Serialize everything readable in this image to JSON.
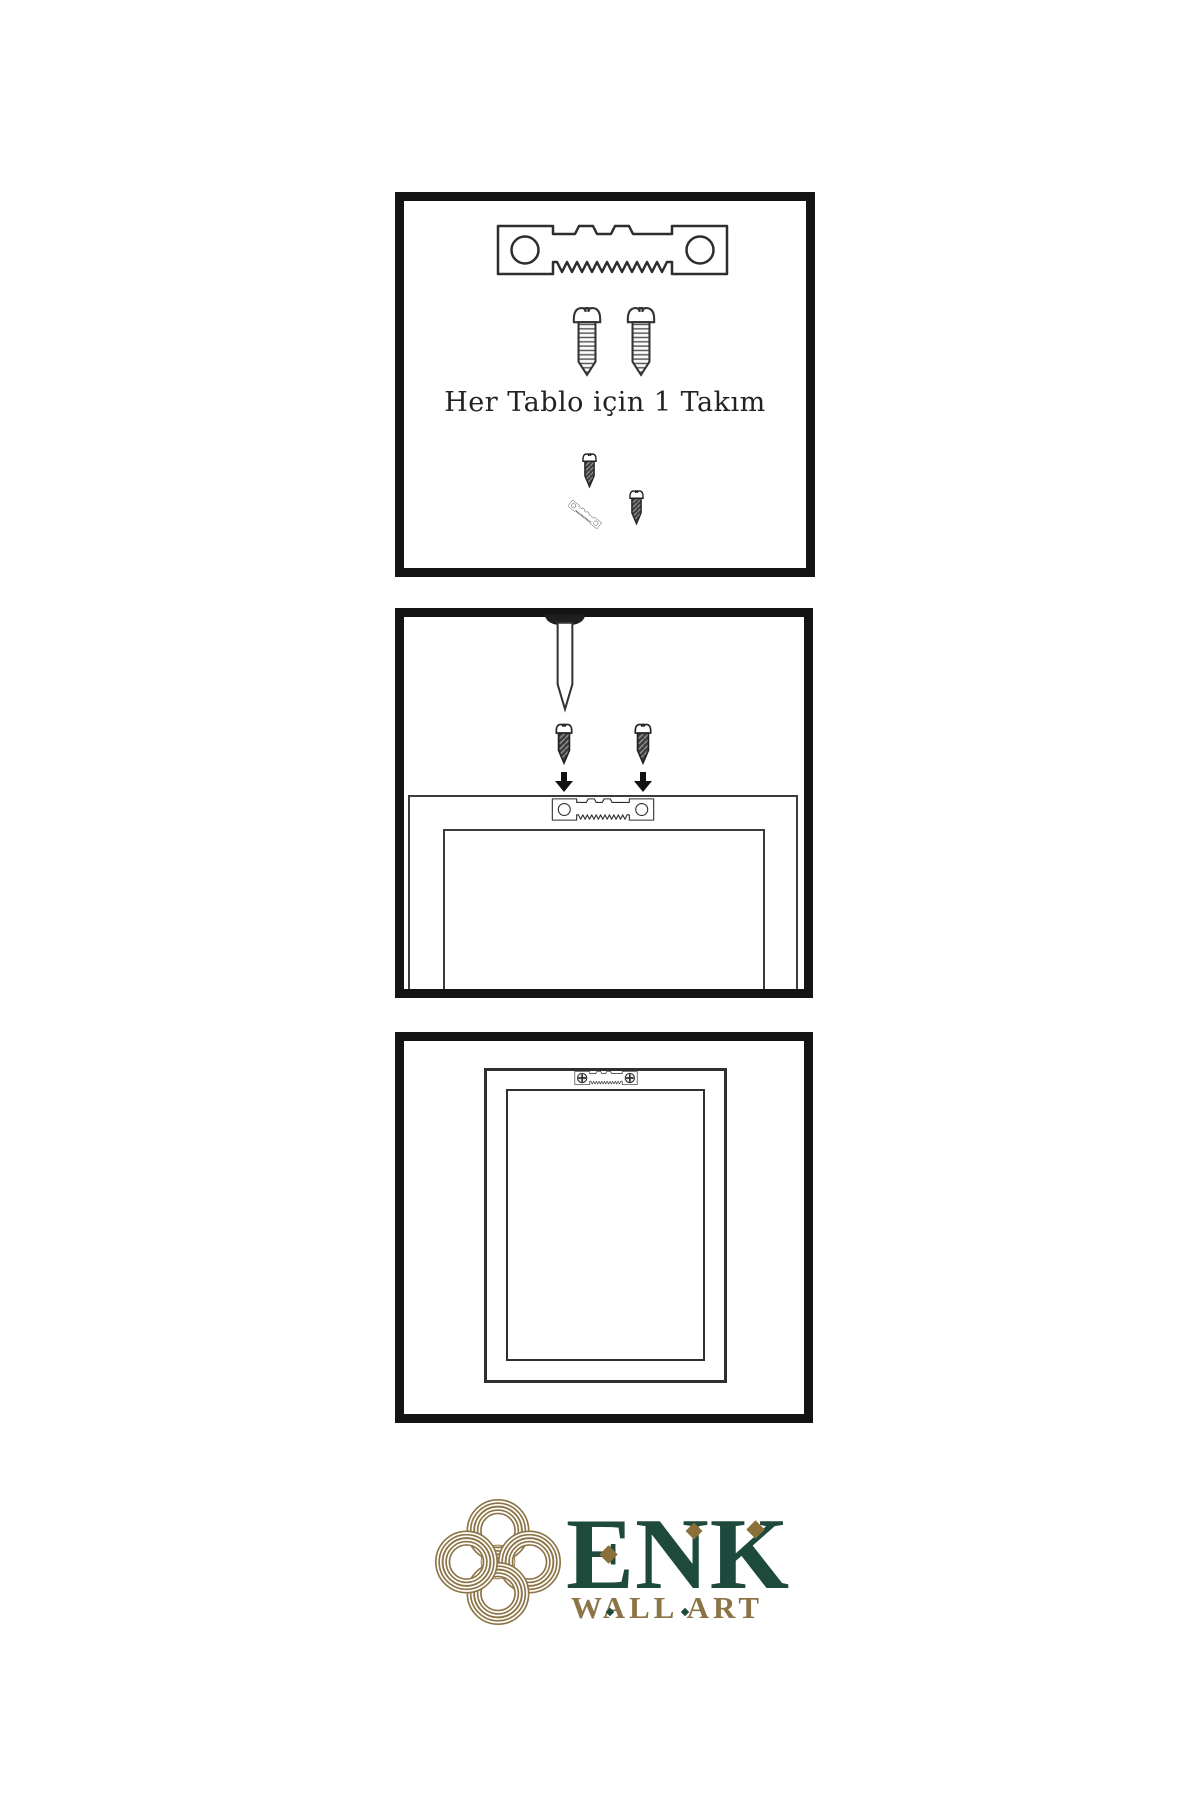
{
  "colors": {
    "background": "#ffffff",
    "panel_border": "#141414",
    "line": "#2e2e2e",
    "text": "#222222",
    "dark_metal": "#3d3d3d",
    "brand_green": "#1d4a3c",
    "brand_gold": "#8c7446",
    "brand_gold_dark": "#8a6f3a"
  },
  "panels": {
    "kit": {
      "name": "hardware-kit",
      "caption": "Her Tablo için 1 Takım",
      "icons": [
        "sawtooth-hanger-icon",
        "screw-icon",
        "screw-icon",
        "small-screw-icon",
        "angled-sawtooth-hanger-icon",
        "small-screw-icon"
      ]
    },
    "mount": {
      "name": "attach-hanger-to-frame-back",
      "icons": [
        "wall-nail-icon",
        "small-screw-icon",
        "small-screw-icon",
        "arrow-down-icon",
        "arrow-down-icon",
        "frame-back-outline",
        "sawtooth-hanger-icon"
      ]
    },
    "hang": {
      "name": "frame-hanging-on-wall",
      "icons": [
        "picture-frame-outline",
        "mounted-sawtooth-hanger-icon"
      ]
    }
  },
  "brand": {
    "name": "ENK",
    "tagline": "WALL ART",
    "logo": "knot-logo"
  }
}
